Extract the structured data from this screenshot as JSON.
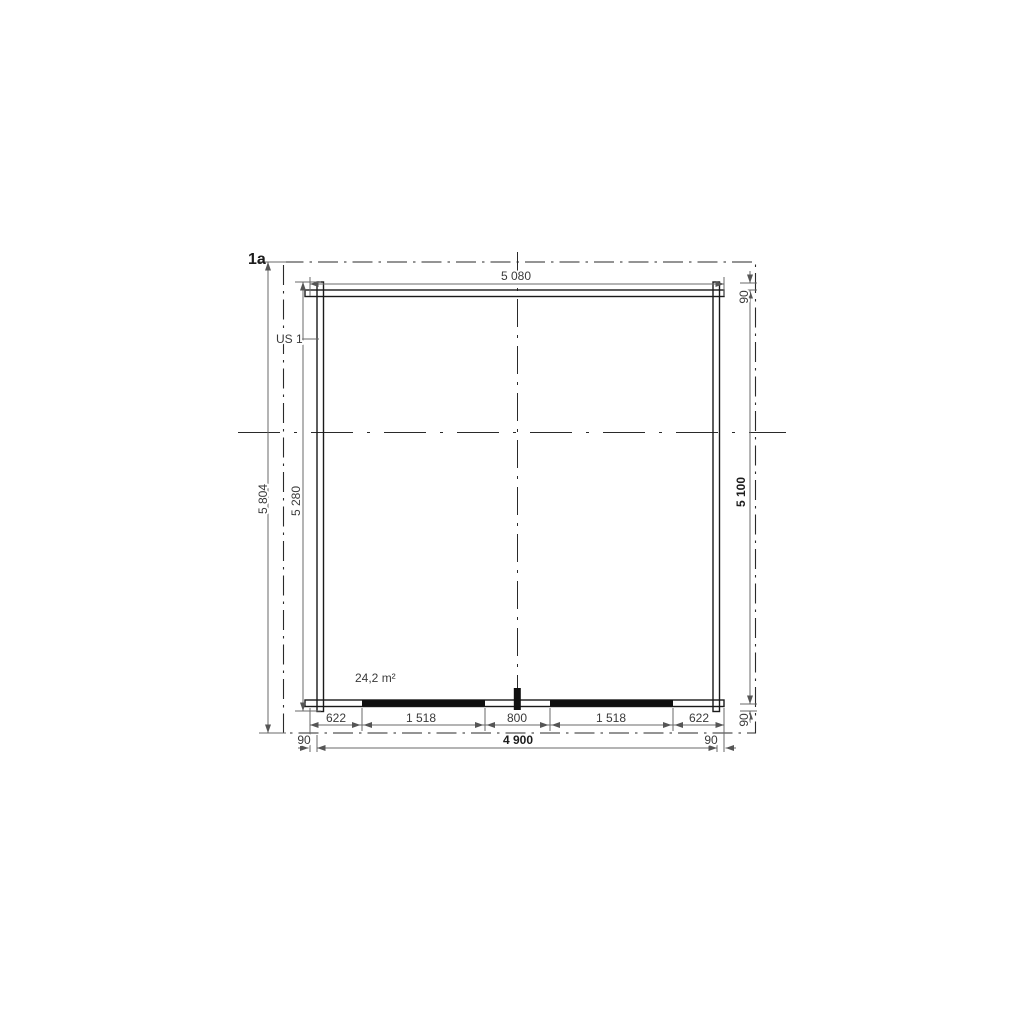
{
  "labels": {
    "section_marker": "1a",
    "wall_unit": "US 1",
    "area": "24,2 m²"
  },
  "dims": {
    "top_width": "5 080",
    "outer_height": "5 804",
    "wall_height": "5 280",
    "inner_height": "5 100",
    "right_top_offset": "90",
    "right_bottom_offset": "90",
    "bottom_left_offset": "90",
    "bottom_right_offset": "90",
    "bottom_total": "4 900",
    "bottom_segments": [
      "622",
      "1 518",
      "800",
      "1 518",
      "622"
    ]
  },
  "colors": {
    "wall_line": "#1a1a1a",
    "dimension_line": "#6a6a6a",
    "text": "#3a3a3a",
    "background": "#ffffff"
  }
}
